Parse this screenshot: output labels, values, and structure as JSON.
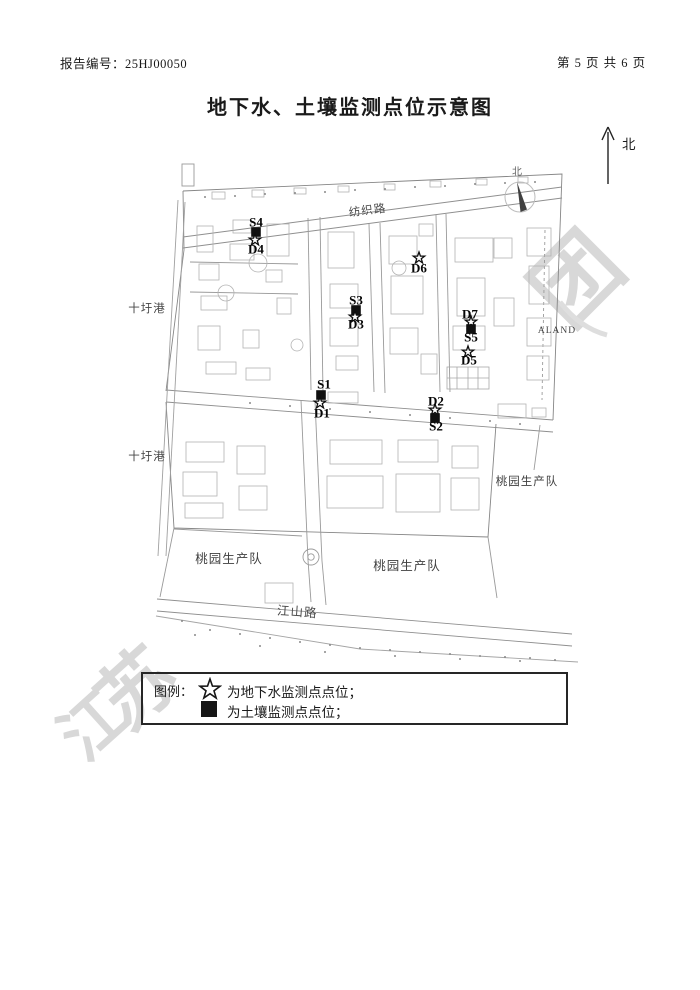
{
  "header": {
    "report_no": "报告编号：25HJ00050",
    "page_info": "第 5 页 共 6 页"
  },
  "title": "地下水、土壤监测点位示意图",
  "north_indicator": {
    "label": "北"
  },
  "compass": {
    "label": "北"
  },
  "map": {
    "road_labels": [
      {
        "name": "fangzhi-road-label",
        "text": "纺织路",
        "x": 368,
        "y": 214,
        "rotate": -7,
        "size": 11.5
      },
      {
        "name": "jiangshan-road-label",
        "text": "江山路",
        "x": 297,
        "y": 616,
        "rotate": 4,
        "size": 12.5
      }
    ],
    "water_labels": [
      {
        "name": "shiwei-port-north-label",
        "text": "十圩港",
        "x": 147,
        "y": 312,
        "size": 11.5
      },
      {
        "name": "shiwei-port-south-label",
        "text": "十圩港",
        "x": 147,
        "y": 460,
        "size": 11.5
      }
    ],
    "area_labels": [
      {
        "name": "aland-label",
        "text": "ALAND",
        "x": 557,
        "y": 333,
        "size": 9.5
      },
      {
        "name": "taoyuan-east-label",
        "text": "桃园生产队",
        "x": 527,
        "y": 485,
        "size": 11.5
      },
      {
        "name": "taoyuan-southwest-label",
        "text": "桃园生产队",
        "x": 229,
        "y": 563,
        "size": 12.5
      },
      {
        "name": "taoyuan-south-label",
        "text": "桃园生产队",
        "x": 407,
        "y": 570,
        "size": 12.5
      }
    ],
    "points": [
      {
        "id": "S4",
        "label": "S4",
        "lx": 256,
        "ly": 222,
        "symbol": "square",
        "px": 256,
        "py": 232
      },
      {
        "id": "D4",
        "label": "D4",
        "lx": 256,
        "ly": 249,
        "symbol": "star",
        "px": 255,
        "py": 240
      },
      {
        "id": "D6",
        "label": "D6",
        "lx": 419,
        "ly": 268,
        "symbol": "star",
        "px": 419,
        "py": 258
      },
      {
        "id": "S3",
        "label": "S3",
        "lx": 356,
        "ly": 300,
        "symbol": "square",
        "px": 356,
        "py": 310
      },
      {
        "id": "D3",
        "label": "D3",
        "lx": 356,
        "ly": 324,
        "symbol": "star",
        "px": 355,
        "py": 317
      },
      {
        "id": "D7",
        "label": "D7",
        "lx": 470,
        "ly": 314,
        "symbol": "star",
        "px": 471,
        "py": 322
      },
      {
        "id": "S5",
        "label": "S5",
        "lx": 471,
        "ly": 337,
        "symbol": "square",
        "px": 471,
        "py": 329
      },
      {
        "id": "D5",
        "label": "D5",
        "lx": 469,
        "ly": 360,
        "symbol": "star",
        "px": 468,
        "py": 352
      },
      {
        "id": "S1",
        "label": "S1",
        "lx": 324,
        "ly": 384,
        "symbol": "square",
        "px": 321,
        "py": 395
      },
      {
        "id": "D1",
        "label": "D1",
        "lx": 322,
        "ly": 413,
        "symbol": "star",
        "px": 320,
        "py": 403
      },
      {
        "id": "D2",
        "label": "D2",
        "lx": 436,
        "ly": 401,
        "symbol": "star",
        "px": 435,
        "py": 410
      },
      {
        "id": "S2",
        "label": "S2",
        "lx": 436,
        "ly": 426,
        "symbol": "square",
        "px": 435,
        "py": 418
      }
    ]
  },
  "legend": {
    "title": "图例：",
    "items": [
      {
        "symbol": "star",
        "text": "为地下水监测点点位；"
      },
      {
        "symbol": "square",
        "text": "为土壤监测点点位；"
      }
    ]
  },
  "watermark": {
    "color": "#d8d8d8",
    "chars": [
      {
        "char": "江",
        "x": 108,
        "y": 742,
        "size": 64,
        "rotate": -42
      },
      {
        "char": "苏",
        "x": 155,
        "y": 708,
        "size": 76,
        "rotate": -42
      },
      {
        "char": "团",
        "x": 598,
        "y": 300,
        "size": 86,
        "rotate": -45
      }
    ]
  }
}
